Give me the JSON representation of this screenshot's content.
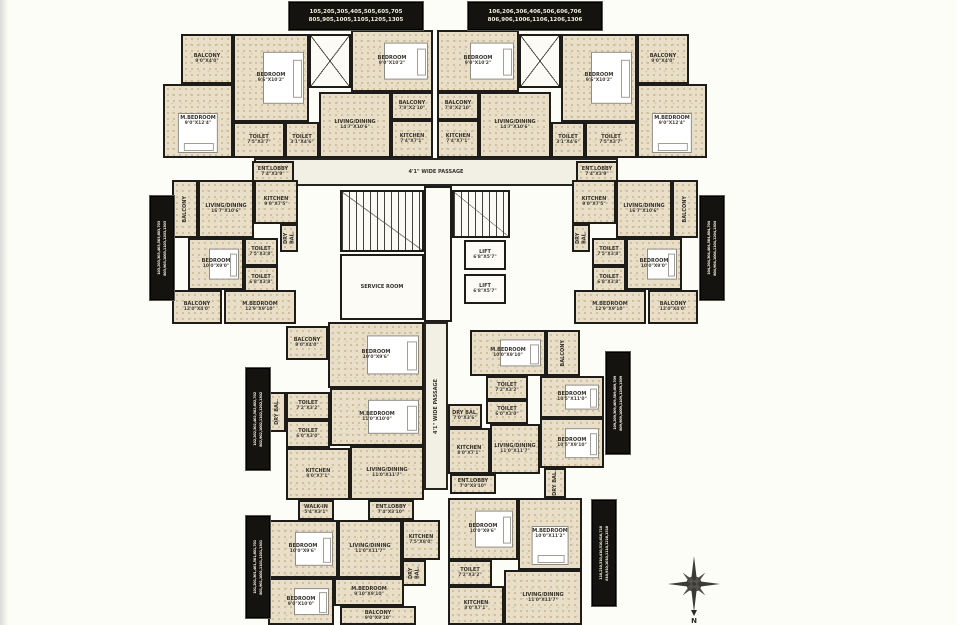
{
  "colors": {
    "wall": "#1d1c19",
    "floor": "#e9dfc8",
    "label_bg": "#14130f",
    "label_fg": "#f3ecda",
    "background": "#fdfdf7"
  },
  "compass": {
    "label": "N"
  },
  "unit_labels": [
    {
      "id": "flat-stack-105",
      "orient": "h",
      "x": 289,
      "y": 2,
      "w": 132,
      "h": 26,
      "line1": "105,205,305,405,505,605,705",
      "line2": "805,905,1005,1105,1205,1305"
    },
    {
      "id": "flat-stack-106",
      "orient": "h",
      "x": 468,
      "y": 2,
      "w": 132,
      "h": 26,
      "line1": "106,206,306,406,506,606,706",
      "line2": "806,906,1006,1106,1206,1306"
    },
    {
      "id": "flat-stack-103",
      "orient": "v",
      "x": 150,
      "y": 196,
      "w": 22,
      "h": 102,
      "line1": "103,203,303,403,503,603,703",
      "line2": "803,903,1003,1103,1203,1303"
    },
    {
      "id": "flat-stack-104",
      "orient": "v",
      "x": 700,
      "y": 196,
      "w": 22,
      "h": 102,
      "line1": "104,204,304,404,504,604,704",
      "line2": "804,904,1004,1104,1204,1304"
    },
    {
      "id": "flat-stack-102",
      "orient": "v",
      "x": 246,
      "y": 368,
      "w": 22,
      "h": 100,
      "line1": "102,202,302,402,502,602,702",
      "line2": "802,902,1002,1102,1202,1302"
    },
    {
      "id": "flat-stack-109",
      "orient": "v",
      "x": 606,
      "y": 352,
      "w": 22,
      "h": 100,
      "line1": "109,209,309,409,509,609,709",
      "line2": "809,909,1009,1109,1209,1309"
    },
    {
      "id": "flat-stack-101",
      "orient": "v",
      "x": 246,
      "y": 516,
      "w": 22,
      "h": 100,
      "line1": "101,201,301,401,501,601,701",
      "line2": "801,901,1001,1101,1201,1301"
    },
    {
      "id": "flat-stack-110",
      "orient": "v",
      "x": 592,
      "y": 500,
      "w": 22,
      "h": 104,
      "line1": "110,210,310,410,510,610,710",
      "line2": "810,910,1010,1110,1210,1310"
    }
  ],
  "rooms": [
    {
      "id": "passage-horizontal",
      "name": "4'1\" WIDE PASSAGE",
      "dims": "",
      "x": 254,
      "y": 158,
      "w": 364,
      "h": 28,
      "kind": "passage"
    },
    {
      "id": "passage-vertical",
      "name": "4'1\" WIDE PASSAGE",
      "dims": "",
      "x": 424,
      "y": 322,
      "w": 24,
      "h": 168,
      "kind": "passage",
      "rot": true
    },
    {
      "id": "core-lobby",
      "name": "",
      "dims": "",
      "x": 424,
      "y": 186,
      "w": 28,
      "h": 136,
      "kind": "white"
    },
    {
      "id": "staircase-left",
      "name": "",
      "dims": "",
      "x": 340,
      "y": 190,
      "w": 84,
      "h": 62,
      "kind": "stair"
    },
    {
      "id": "service-room",
      "name": "SERVICE ROOM",
      "dims": "",
      "x": 340,
      "y": 254,
      "w": 84,
      "h": 66,
      "kind": "white"
    },
    {
      "id": "staircase-right",
      "name": "",
      "dims": "",
      "x": 452,
      "y": 190,
      "w": 58,
      "h": 48,
      "kind": "stair"
    },
    {
      "id": "lift-1",
      "name": "LIFT",
      "dims": "6'8\"X5'7\"",
      "x": 464,
      "y": 240,
      "w": 42,
      "h": 30,
      "kind": "white"
    },
    {
      "id": "lift-2",
      "name": "LIFT",
      "dims": "6'8\"X5'7\"",
      "x": 464,
      "y": 274,
      "w": 42,
      "h": 30,
      "kind": "white"
    },
    {
      "id": "u05-balcony",
      "name": "BALCONY",
      "dims": "9'0\"X4'0\"",
      "x": 181,
      "y": 34,
      "w": 52,
      "h": 50,
      "kind": "floor"
    },
    {
      "id": "u05-mbedroom",
      "name": "M.BEDROOM",
      "dims": "9'0\"X12'4\"",
      "x": 163,
      "y": 84,
      "w": 70,
      "h": 74,
      "kind": "floor",
      "bed": "v"
    },
    {
      "id": "u05-bedroom",
      "name": "BEDROOM",
      "dims": "9'6\"X10'2\"",
      "x": 233,
      "y": 34,
      "w": 76,
      "h": 88,
      "kind": "floor",
      "bed": "h"
    },
    {
      "id": "u05-toilet-1",
      "name": "TOILET",
      "dims": "7'5\"X3'7\"",
      "x": 233,
      "y": 122,
      "w": 52,
      "h": 36,
      "kind": "floor"
    },
    {
      "id": "u05-toilet-2",
      "name": "TOILET",
      "dims": "3'1\"X4'6\"",
      "x": 285,
      "y": 122,
      "w": 34,
      "h": 36,
      "kind": "floor"
    },
    {
      "id": "u05-duct",
      "name": "",
      "dims": "",
      "x": 309,
      "y": 34,
      "w": 42,
      "h": 54,
      "kind": "void"
    },
    {
      "id": "u05-bedroom-2",
      "name": "BEDROOM",
      "dims": "9'0\"X10'2\"",
      "x": 351,
      "y": 30,
      "w": 82,
      "h": 62,
      "kind": "floor",
      "bed": "h"
    },
    {
      "id": "u05-living",
      "name": "LIVING/DINING",
      "dims": "14'7\"X10'6\"",
      "x": 319,
      "y": 92,
      "w": 72,
      "h": 66,
      "kind": "floor"
    },
    {
      "id": "u05-balcony-2",
      "name": "BALCONY",
      "dims": "7'8\"X2'10\"",
      "x": 391,
      "y": 92,
      "w": 42,
      "h": 28,
      "kind": "floor"
    },
    {
      "id": "u05-kitchen",
      "name": "KITCHEN",
      "dims": "7'4\"X7'1\"",
      "x": 391,
      "y": 120,
      "w": 42,
      "h": 38,
      "kind": "floor"
    },
    {
      "id": "u06-bedroom-2",
      "name": "BEDROOM",
      "dims": "9'0\"X10'2\"",
      "x": 437,
      "y": 30,
      "w": 82,
      "h": 62,
      "kind": "floor",
      "bed": "h"
    },
    {
      "id": "u06-balcony-2",
      "name": "BALCONY",
      "dims": "7'8\"X2'10\"",
      "x": 437,
      "y": 92,
      "w": 42,
      "h": 28,
      "kind": "floor"
    },
    {
      "id": "u06-kitchen",
      "name": "KITCHEN",
      "dims": "7'4\"X7'1\"",
      "x": 437,
      "y": 120,
      "w": 42,
      "h": 38,
      "kind": "floor"
    },
    {
      "id": "u06-living",
      "name": "LIVING/DINING",
      "dims": "14'7\"X10'6\"",
      "x": 479,
      "y": 92,
      "w": 72,
      "h": 66,
      "kind": "floor"
    },
    {
      "id": "u06-duct",
      "name": "",
      "dims": "",
      "x": 519,
      "y": 34,
      "w": 42,
      "h": 54,
      "kind": "void"
    },
    {
      "id": "u06-bedroom",
      "name": "BEDROOM",
      "dims": "9'6\"X10'2\"",
      "x": 561,
      "y": 34,
      "w": 76,
      "h": 88,
      "kind": "floor",
      "bed": "h"
    },
    {
      "id": "u06-toilet-2",
      "name": "TOILET",
      "dims": "3'1\"X4'6\"",
      "x": 551,
      "y": 122,
      "w": 34,
      "h": 36,
      "kind": "floor"
    },
    {
      "id": "u06-toilet-1",
      "name": "TOILET",
      "dims": "7'5\"X3'7\"",
      "x": 585,
      "y": 122,
      "w": 52,
      "h": 36,
      "kind": "floor"
    },
    {
      "id": "u06-mbedroom",
      "name": "M.BEDROOM",
      "dims": "9'0\"X12'4\"",
      "x": 637,
      "y": 84,
      "w": 70,
      "h": 74,
      "kind": "floor",
      "bed": "v"
    },
    {
      "id": "u06-balcony",
      "name": "BALCONY",
      "dims": "9'0\"X4'0\"",
      "x": 637,
      "y": 34,
      "w": 52,
      "h": 50,
      "kind": "floor"
    },
    {
      "id": "u03-ent-lobby",
      "name": "ENT.LOBBY",
      "dims": "7'4\"X3'9\"",
      "x": 252,
      "y": 161,
      "w": 42,
      "h": 22,
      "kind": "floor"
    },
    {
      "id": "u03-balcony-1",
      "name": "BALCONY",
      "dims": "",
      "x": 172,
      "y": 180,
      "w": 26,
      "h": 58,
      "kind": "floor",
      "rot": true
    },
    {
      "id": "u03-living",
      "name": "LIVING/DINING",
      "dims": "16'7\"X10'6\"",
      "x": 198,
      "y": 180,
      "w": 56,
      "h": 58,
      "kind": "floor"
    },
    {
      "id": "u03-kitchen",
      "name": "KITCHEN",
      "dims": "9'0\"X7'5\"",
      "x": 254,
      "y": 180,
      "w": 44,
      "h": 44,
      "kind": "floor"
    },
    {
      "id": "u03-dry-bal",
      "name": "DRY BAL.",
      "dims": "",
      "x": 280,
      "y": 224,
      "w": 18,
      "h": 28,
      "kind": "floor",
      "rot": true
    },
    {
      "id": "u03-bedroom",
      "name": "BEDROOM",
      "dims": "10'0\"X9'0\"",
      "x": 188,
      "y": 238,
      "w": 56,
      "h": 52,
      "kind": "floor",
      "bed": "h"
    },
    {
      "id": "u03-toilet-1",
      "name": "TOILET",
      "dims": "7'5\"X3'8\"",
      "x": 244,
      "y": 238,
      "w": 34,
      "h": 28,
      "kind": "floor"
    },
    {
      "id": "u03-toilet-2",
      "name": "TOILET",
      "dims": "6'8\"X3'8\"",
      "x": 244,
      "y": 266,
      "w": 34,
      "h": 28,
      "kind": "floor"
    },
    {
      "id": "u03-mbedroom",
      "name": "M.BEDROOM",
      "dims": "12'9\"X9'10\"",
      "x": 224,
      "y": 290,
      "w": 72,
      "h": 34,
      "kind": "floor"
    },
    {
      "id": "u03-balcony-2",
      "name": "BALCONY",
      "dims": "12'0\"X4'0\"",
      "x": 172,
      "y": 290,
      "w": 50,
      "h": 34,
      "kind": "floor"
    },
    {
      "id": "u04-ent-lobby",
      "name": "ENT.LOBBY",
      "dims": "7'4\"X3'9\"",
      "x": 576,
      "y": 161,
      "w": 42,
      "h": 22,
      "kind": "floor"
    },
    {
      "id": "u04-balcony-1",
      "name": "BALCONY",
      "dims": "",
      "x": 672,
      "y": 180,
      "w": 26,
      "h": 58,
      "kind": "floor",
      "rot": true
    },
    {
      "id": "u04-living",
      "name": "LIVING/DINING",
      "dims": "16'7\"X10'6\"",
      "x": 616,
      "y": 180,
      "w": 56,
      "h": 58,
      "kind": "floor"
    },
    {
      "id": "u04-kitchen",
      "name": "KITCHEN",
      "dims": "9'0\"X7'5\"",
      "x": 572,
      "y": 180,
      "w": 44,
      "h": 44,
      "kind": "floor"
    },
    {
      "id": "u04-dry-bal",
      "name": "DRY BAL.",
      "dims": "",
      "x": 572,
      "y": 224,
      "w": 18,
      "h": 28,
      "kind": "floor",
      "rot": true
    },
    {
      "id": "u04-bedroom",
      "name": "BEDROOM",
      "dims": "10'0\"X9'0\"",
      "x": 626,
      "y": 238,
      "w": 56,
      "h": 52,
      "kind": "floor",
      "bed": "h"
    },
    {
      "id": "u04-toilet-1",
      "name": "TOILET",
      "dims": "7'5\"X3'8\"",
      "x": 592,
      "y": 238,
      "w": 34,
      "h": 28,
      "kind": "floor"
    },
    {
      "id": "u04-toilet-2",
      "name": "TOILET",
      "dims": "6'8\"X3'8\"",
      "x": 592,
      "y": 266,
      "w": 34,
      "h": 28,
      "kind": "floor"
    },
    {
      "id": "u04-mbedroom",
      "name": "M.BEDROOM",
      "dims": "12'9\"X9'10\"",
      "x": 574,
      "y": 290,
      "w": 72,
      "h": 34,
      "kind": "floor"
    },
    {
      "id": "u04-balcony-2",
      "name": "BALCONY",
      "dims": "12'0\"X4'0\"",
      "x": 648,
      "y": 290,
      "w": 50,
      "h": 34,
      "kind": "floor"
    },
    {
      "id": "u02-balcony",
      "name": "BALCONY",
      "dims": "9'0\"X4'0\"",
      "x": 286,
      "y": 326,
      "w": 42,
      "h": 34,
      "kind": "floor"
    },
    {
      "id": "u02-bedroom",
      "name": "BEDROOM",
      "dims": "10'0\"X9'6\"",
      "x": 328,
      "y": 322,
      "w": 96,
      "h": 66,
      "kind": "floor",
      "bed": "h"
    },
    {
      "id": "u02-dry-bal",
      "name": "DRY BAL.",
      "dims": "",
      "x": 268,
      "y": 392,
      "w": 18,
      "h": 40,
      "kind": "floor",
      "rot": true
    },
    {
      "id": "u02-toilet-1",
      "name": "TOILET",
      "dims": "7'2\"X3'2\"",
      "x": 286,
      "y": 392,
      "w": 44,
      "h": 28,
      "kind": "floor"
    },
    {
      "id": "u02-toilet-2",
      "name": "TOILET",
      "dims": "6'0\"X3'0\"",
      "x": 286,
      "y": 420,
      "w": 44,
      "h": 28,
      "kind": "floor"
    },
    {
      "id": "u02-mbedroom",
      "name": "M.BEDROOM",
      "dims": "11'0\"X10'0\"",
      "x": 330,
      "y": 388,
      "w": 94,
      "h": 58,
      "kind": "floor",
      "bed": "h"
    },
    {
      "id": "u02-kitchen",
      "name": "KITCHEN",
      "dims": "8'0\"X7'1\"",
      "x": 286,
      "y": 448,
      "w": 64,
      "h": 52,
      "kind": "floor"
    },
    {
      "id": "u02-living",
      "name": "LIVING/DINING",
      "dims": "11'0\"X11'7\"",
      "x": 350,
      "y": 446,
      "w": 74,
      "h": 54,
      "kind": "floor"
    },
    {
      "id": "u01-walk-in",
      "name": "WALK-IN",
      "dims": "5'4\"X3'1\"",
      "x": 298,
      "y": 500,
      "w": 36,
      "h": 20,
      "kind": "floor"
    },
    {
      "id": "u01-ent-lobby",
      "name": "ENT.LOBBY",
      "dims": "7'4\"X3'10\"",
      "x": 368,
      "y": 500,
      "w": 46,
      "h": 20,
      "kind": "floor"
    },
    {
      "id": "u01-bedroom-1",
      "name": "BEDROOM",
      "dims": "10'0\"X9'6\"",
      "x": 268,
      "y": 520,
      "w": 70,
      "h": 58,
      "kind": "floor",
      "bed": "h"
    },
    {
      "id": "u01-living",
      "name": "LIVING/DINING",
      "dims": "11'0\"X11'7\"",
      "x": 338,
      "y": 520,
      "w": 64,
      "h": 58,
      "kind": "floor"
    },
    {
      "id": "u01-kitchen",
      "name": "KITCHEN",
      "dims": "7'5\"X8'0\"",
      "x": 402,
      "y": 520,
      "w": 38,
      "h": 40,
      "kind": "floor"
    },
    {
      "id": "u01-dry-bal",
      "name": "DRY BAL.",
      "dims": "",
      "x": 402,
      "y": 560,
      "w": 24,
      "h": 26,
      "kind": "floor",
      "rot": true
    },
    {
      "id": "u01-bedroom-2",
      "name": "BEDROOM",
      "dims": "9'0\"X10'0\"",
      "x": 268,
      "y": 578,
      "w": 66,
      "h": 47,
      "kind": "floor",
      "bed": "h"
    },
    {
      "id": "u01-mbedroom",
      "name": "M.BEDROOM",
      "dims": "9'10\"X9'10\"",
      "x": 334,
      "y": 578,
      "w": 70,
      "h": 28,
      "kind": "floor"
    },
    {
      "id": "u01-balcony",
      "name": "BALCONY",
      "dims": "9'0\"X9'10\"",
      "x": 340,
      "y": 606,
      "w": 76,
      "h": 19,
      "kind": "floor"
    },
    {
      "id": "u09-mbedroom",
      "name": "M.BEDROOM",
      "dims": "10'0\"X9'10\"",
      "x": 470,
      "y": 330,
      "w": 76,
      "h": 46,
      "kind": "floor",
      "bed": "h"
    },
    {
      "id": "u09-balcony",
      "name": "BALCONY",
      "dims": "",
      "x": 546,
      "y": 330,
      "w": 34,
      "h": 46,
      "kind": "floor",
      "rot": true
    },
    {
      "id": "u09-toilet-1",
      "name": "TOILET",
      "dims": "7'2\"X3'2\"",
      "x": 486,
      "y": 376,
      "w": 42,
      "h": 24,
      "kind": "floor"
    },
    {
      "id": "u09-toilet-2",
      "name": "TOILET",
      "dims": "6'0\"X3'0\"",
      "x": 486,
      "y": 400,
      "w": 42,
      "h": 24,
      "kind": "floor"
    },
    {
      "id": "u09-bedroom-1",
      "name": "BEDROOM",
      "dims": "10'5\"X11'0\"",
      "x": 540,
      "y": 376,
      "w": 64,
      "h": 42,
      "kind": "floor",
      "bed": "h"
    },
    {
      "id": "u09-dry-bal-1",
      "name": "DRY BAL.",
      "dims": "7'0\"X3'6\"",
      "x": 448,
      "y": 404,
      "w": 34,
      "h": 24,
      "kind": "floor"
    },
    {
      "id": "u09-kitchen",
      "name": "KITCHEN",
      "dims": "8'0\"X7'1\"",
      "x": 448,
      "y": 428,
      "w": 42,
      "h": 46,
      "kind": "floor"
    },
    {
      "id": "u09-living",
      "name": "LIVING/DINING",
      "dims": "11'0\"X11'7\"",
      "x": 490,
      "y": 424,
      "w": 50,
      "h": 50,
      "kind": "floor"
    },
    {
      "id": "u09-bedroom-2",
      "name": "BEDROOM",
      "dims": "10'5\"X9'10\"",
      "x": 540,
      "y": 418,
      "w": 64,
      "h": 50,
      "kind": "floor",
      "bed": "h"
    },
    {
      "id": "u09-ent-lobby",
      "name": "ENT.LOBBY",
      "dims": "7'0\"X3'10\"",
      "x": 450,
      "y": 474,
      "w": 46,
      "h": 20,
      "kind": "floor"
    },
    {
      "id": "u09-dry-bal-2",
      "name": "DRY BAL.",
      "dims": "",
      "x": 544,
      "y": 468,
      "w": 22,
      "h": 30,
      "kind": "floor",
      "rot": true
    },
    {
      "id": "u10-bedroom",
      "name": "BEDROOM",
      "dims": "10'0\"X9'6\"",
      "x": 448,
      "y": 498,
      "w": 70,
      "h": 62,
      "kind": "floor",
      "bed": "h"
    },
    {
      "id": "u10-mbedroom",
      "name": "M.BEDROOM",
      "dims": "10'0\"X11'2\"",
      "x": 518,
      "y": 498,
      "w": 64,
      "h": 72,
      "kind": "floor",
      "bed": "v"
    },
    {
      "id": "u10-toilet",
      "name": "TOILET",
      "dims": "7'2\"X3'2\"",
      "x": 448,
      "y": 560,
      "w": 44,
      "h": 26,
      "kind": "floor"
    },
    {
      "id": "u10-kitchen",
      "name": "KITCHEN",
      "dims": "8'0\"X7'1\"",
      "x": 448,
      "y": 586,
      "w": 56,
      "h": 39,
      "kind": "floor"
    },
    {
      "id": "u10-living",
      "name": "LIVING/DINING",
      "dims": "11'0\"X11'7\"",
      "x": 504,
      "y": 570,
      "w": 78,
      "h": 55,
      "kind": "floor"
    }
  ]
}
